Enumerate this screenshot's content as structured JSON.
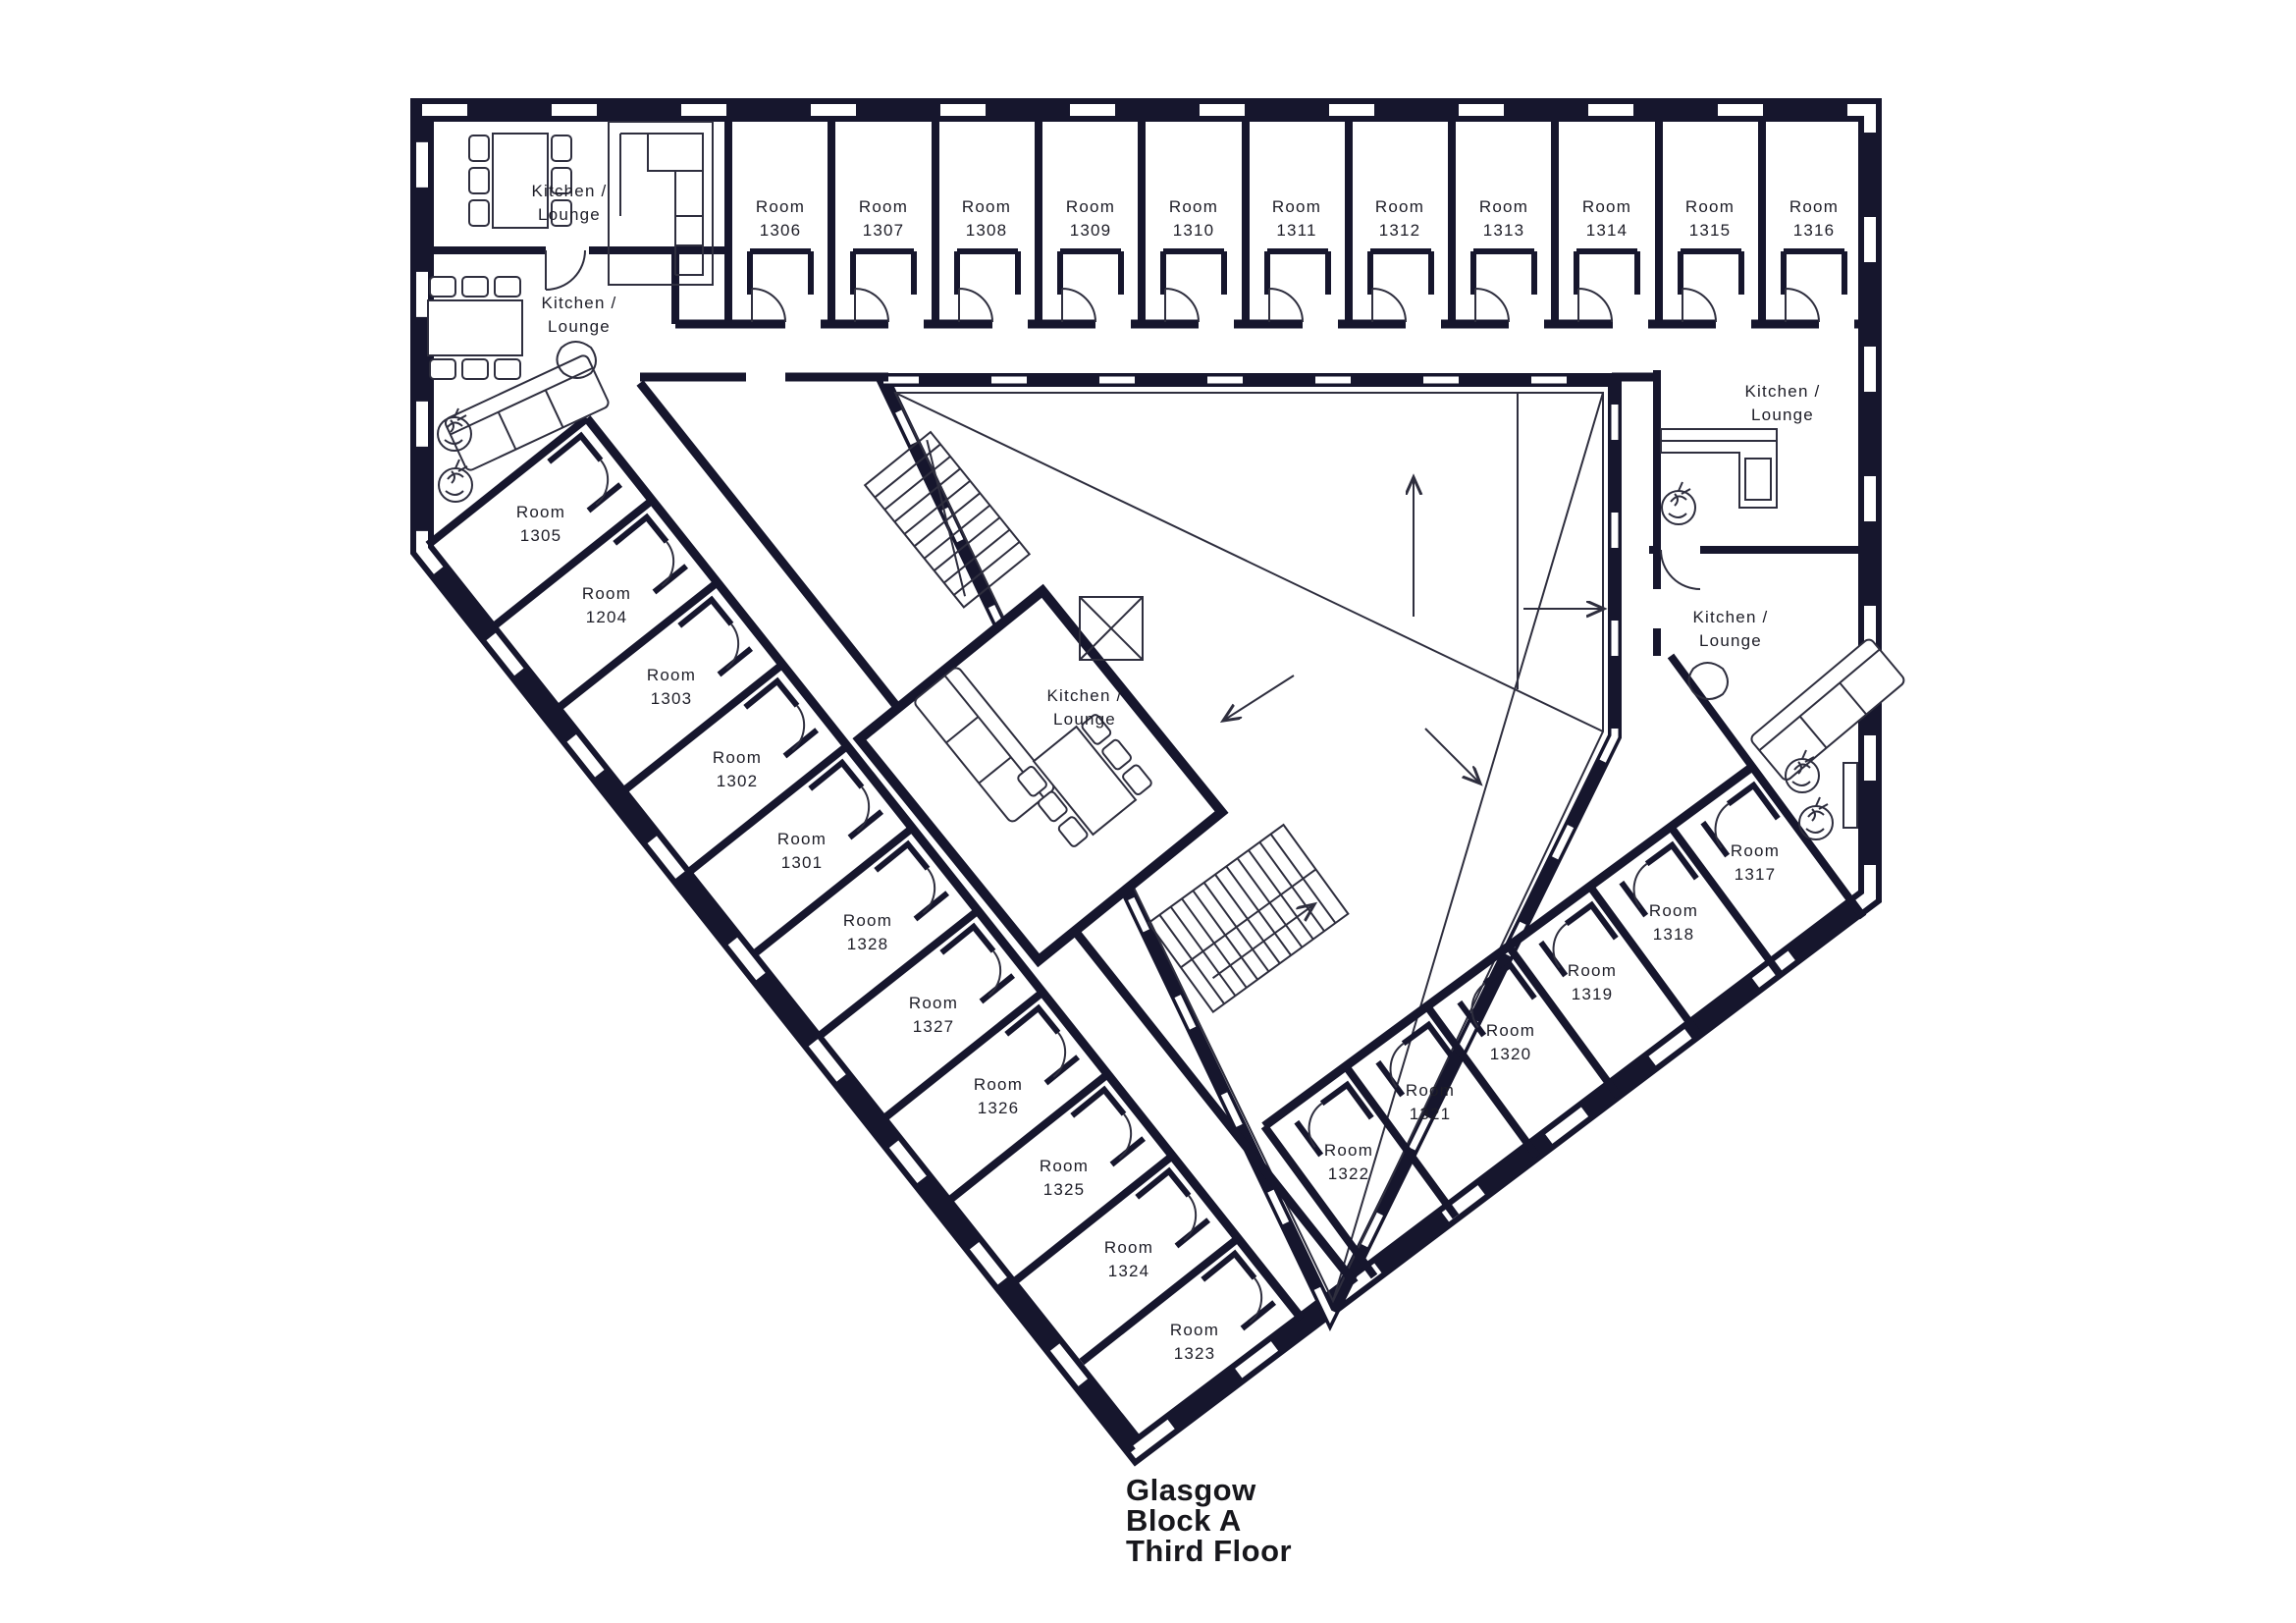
{
  "palette": {
    "wall": "#16162d",
    "line": "#2e2e3e",
    "text": "#1d1d27",
    "background": "#ffffff"
  },
  "title": [
    "Glasgow",
    "Block A",
    "Third Floor"
  ],
  "labels": {
    "room_word": "Room",
    "kitchen_line1": "Kitchen /",
    "kitchen_line2": "Lounge"
  },
  "rooms": {
    "top_row": [
      "1306",
      "1307",
      "1308",
      "1309",
      "1310",
      "1311",
      "1312",
      "1313",
      "1314",
      "1315",
      "1316"
    ],
    "left_wing": [
      "1305",
      "1204",
      "1303",
      "1302",
      "1301",
      "1328",
      "1327",
      "1326",
      "1325",
      "1324",
      "1323"
    ],
    "right_wing": [
      "1317",
      "1318",
      "1319",
      "1320",
      "1321",
      "1322"
    ]
  }
}
